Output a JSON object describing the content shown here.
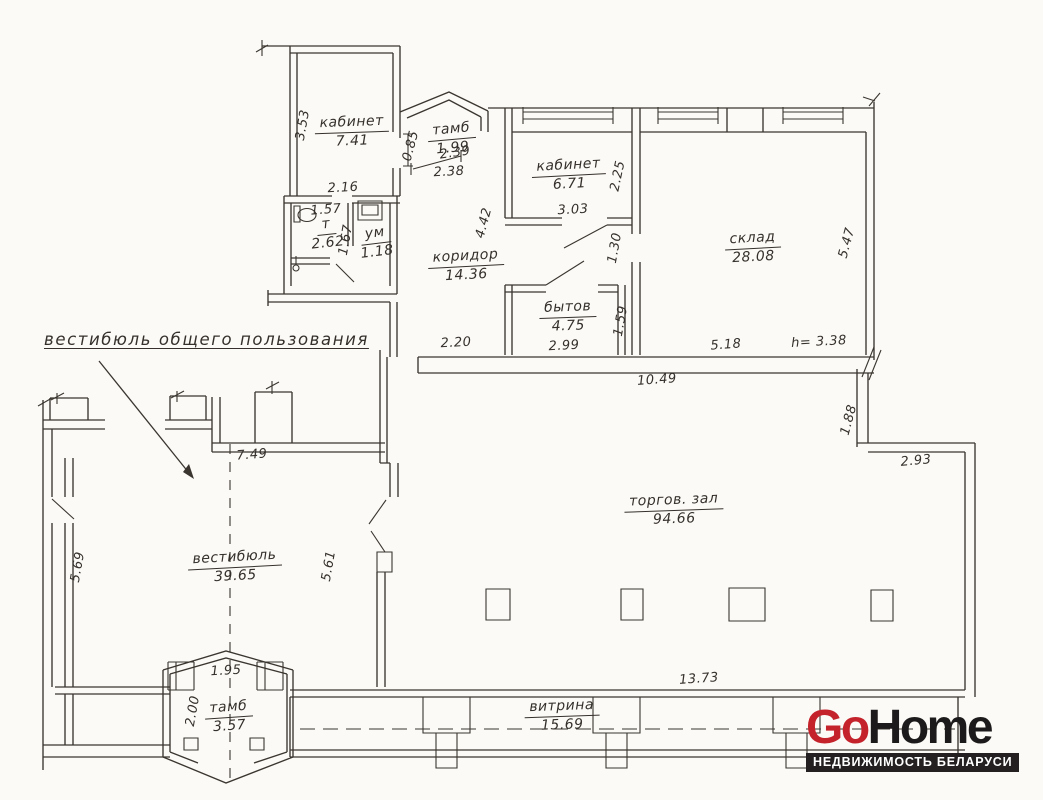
{
  "document": {
    "kind": "apartment-floor-plan-scan",
    "paper_color": "#fbfaf6",
    "ink_color": "#3a352f"
  },
  "annotation": {
    "label": "вестибюль общего пользования"
  },
  "rooms": [
    {
      "name": "кабинет",
      "area": "7.41"
    },
    {
      "name": "тамб",
      "area": "1.99"
    },
    {
      "name": "кабинет",
      "area": "6.71"
    },
    {
      "name": "т",
      "area": "2.62"
    },
    {
      "name": "ум",
      "area": "1.18"
    },
    {
      "name": "коридор",
      "area": "14.36"
    },
    {
      "name": "склад",
      "area": "28.08"
    },
    {
      "name": "бытов",
      "area": "4.75"
    },
    {
      "name": "вестибюль",
      "area": "39.65"
    },
    {
      "name": "торгов. зал",
      "area": "94.66"
    },
    {
      "name": "тамб",
      "area": "3.57"
    },
    {
      "name": "витрина",
      "area": "15.69"
    }
  ],
  "dims": [
    "3.53",
    "2.16",
    "0.85",
    "2.39",
    "2.38",
    "3.03",
    "2.25",
    "1.57",
    "1.67",
    "4.42",
    "1.30",
    "5.47",
    "1.59",
    "2.99",
    "2.20",
    "5.18",
    "h= 3.38",
    "10.49",
    "7.49",
    "5.69",
    "5.61",
    "1.88",
    "2.93",
    "1.95",
    "2.00",
    "13.73"
  ],
  "logo": {
    "part1": "Go",
    "part2": "Home",
    "tagline": "НЕДВИЖИМОСТЬ БЕЛАРУСИ",
    "accent_color": "#c4232c",
    "dark_color": "#1d1a1b"
  }
}
